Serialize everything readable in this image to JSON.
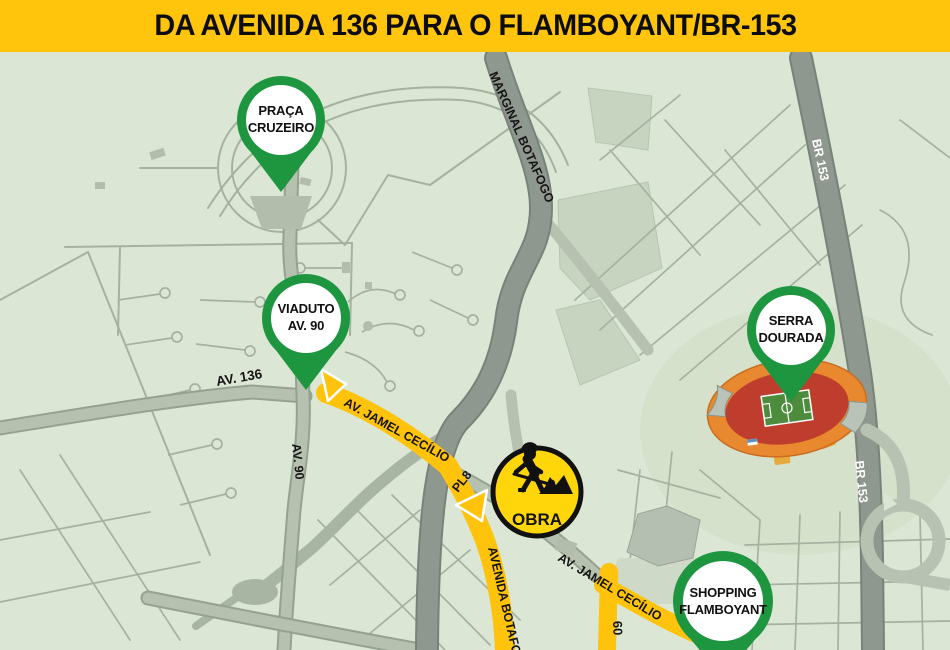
{
  "title": {
    "text": "DA AVENIDA 136 PARA O FLAMBOYANT/BR-153"
  },
  "markers": [
    {
      "id": "praca-cruzeiro",
      "line1": "PRAÇA",
      "line2": "CRUZEIRO"
    },
    {
      "id": "viaduto-av90",
      "line1": "VIADUTO",
      "line2": "AV. 90"
    },
    {
      "id": "serra-dourada",
      "line1": "SERRA",
      "line2": "DOURADA"
    },
    {
      "id": "shopping-flamboyant",
      "line1": "SHOPPING",
      "line2": "FLAMBOYANT"
    }
  ],
  "construction": {
    "label": "OBRA"
  },
  "roads": {
    "marginal_botafogo": "MARGINAL BOTAFOGO",
    "br153_north": "BR 153",
    "br153_south": "BR 153",
    "av_136": "AV. 136",
    "av_90": "AV. 90",
    "av_jamel_cecilio_west": "AV. JAMEL CECÍLIO",
    "av_jamel_cecilio_east": "AV. JAMEL CECÍLIO",
    "pl8": "PL8",
    "avenida_botafogo": "AVENIDA BOTAFOGO",
    "rua_60": "60"
  },
  "colors": {
    "title_bg": "#FFC40C",
    "map_bg": "#DBE6D5",
    "route_yellow": "#FFC30B",
    "pin_green": "#1E9640",
    "construction_yellow": "#FFD60A",
    "major_road_gray": "#8E988E"
  }
}
